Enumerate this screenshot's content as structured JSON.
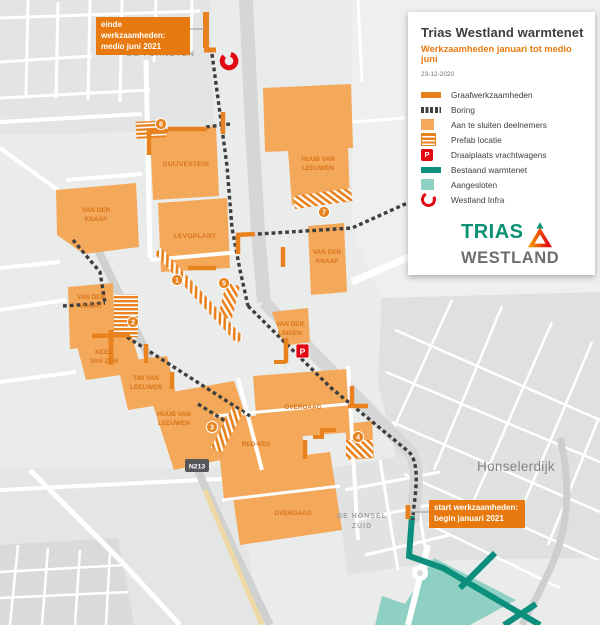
{
  "panel": {
    "title": "Trias Westland warmtenet",
    "subtitle": "Werkzaamheden januari tot medio juni",
    "date": "23-12-2020",
    "legend": [
      {
        "label": "Graafwerkzaamheden",
        "swatch": "solid-orange-bar"
      },
      {
        "label": "Boring",
        "swatch": "dashed-dark-bar"
      },
      {
        "label": "Aan te sluiten deelnemers",
        "swatch": "light-orange-square"
      },
      {
        "label": "Prefab locatie",
        "swatch": "striped-orange-square"
      },
      {
        "label": "Draaiplaats vrachtwagens",
        "swatch": "red-p-square"
      },
      {
        "label": "Bestaand warmtenet",
        "swatch": "solid-teal-bar"
      },
      {
        "label": "Aangesloten",
        "swatch": "light-teal-square"
      },
      {
        "label": "Westland Infra",
        "swatch": "red-open-ring"
      }
    ],
    "logo_line1": "TRIAS",
    "logo_line2": "WESTLAND"
  },
  "callouts": {
    "einde_line1": "einde werkzaamheden:",
    "einde_line2": "medio juni 2021",
    "start_line1": "start werkzaamheden:",
    "start_line2": "begin januari 2021"
  },
  "map": {
    "area_labels": {
      "de_planeten": "DE PLANETEN",
      "honselerdijk": "Honselerdijk",
      "de_honsel_line1": "DE HONSEL",
      "de_honsel_line2": "ZUID",
      "road_badge": "N213"
    },
    "parcels": {
      "duijvestein": {
        "line1": "DUIJVESTEIN"
      },
      "levoplant": {
        "line1": "LEVOPLANT"
      },
      "huub_van_leeuwen_noord": {
        "line1": "HUUB VAN",
        "line2": "LEEUWEN"
      },
      "van_der_knaap_oost": {
        "line1": "VAN DER",
        "line2": "KNAAP"
      },
      "van_der_knaap_west": {
        "line1": "VAN DER",
        "line2": "KNAAP"
      },
      "van_der_voort": {
        "line1": "VAN DER",
        "line2": "VOORT"
      },
      "kees_van_zon": {
        "line1": "KEES",
        "line2": "VAN ZON"
      },
      "tim_van_leeuwen": {
        "line1": "TIM VAN",
        "line2": "LEEUWEN"
      },
      "huub_van_leeuwen_zuid": {
        "line1": "HUUB VAN",
        "line2": "LEEUWEN"
      },
      "red_kes": {
        "line1": "RED-KES"
      },
      "overgaag_noord": {
        "line1": "OVERGAAG"
      },
      "overgaag_zuid": {
        "line1": "OVERGAAG"
      },
      "van_der_linden": {
        "line1": "VAN DER",
        "line2": "LINDEN"
      }
    },
    "badges": [
      "1",
      "2",
      "3",
      "4",
      "5",
      "6",
      "7"
    ],
    "p_marker": "P"
  },
  "colors": {
    "accent_orange": "#e8790f",
    "parcel_orange": "#f3a959",
    "boring_dark": "#3e3e3e",
    "teal_dark": "#0c8f7c",
    "teal_light": "#8fd0c4",
    "red": "#e30613",
    "logo_green": "#0c9174",
    "logo_gray": "#6d6e6d"
  }
}
